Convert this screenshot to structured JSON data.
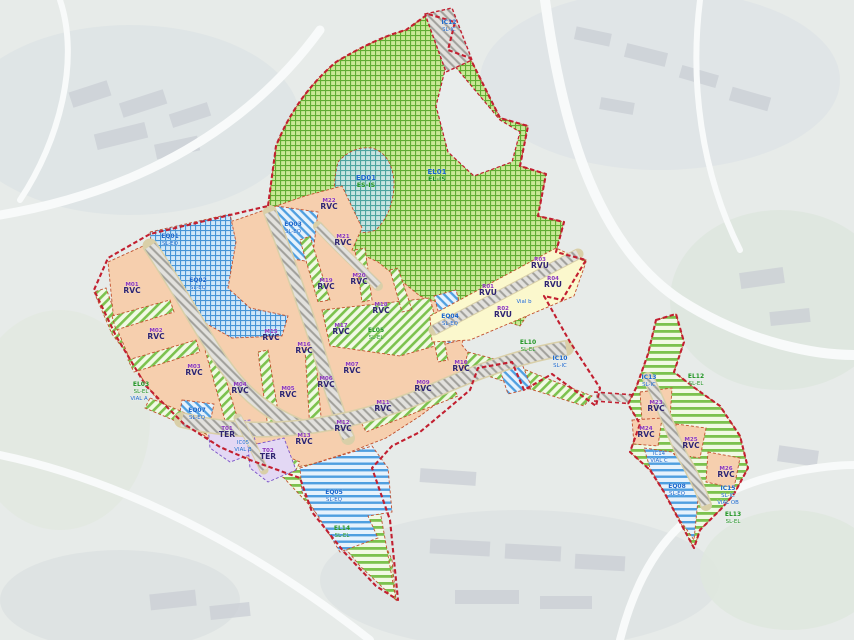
{
  "map": {
    "description": "Urban sector zoning plan over aerial photo",
    "colors": {
      "rvc_parcel": "#f6cfae",
      "rvu_parcel": "#fbf8cd",
      "ter_parcel": "#e3d8f4",
      "green_open_space": "#7cc24e",
      "blue_equipment": "#4f9fe0",
      "teal_zone": "#4da49f",
      "road_hatch": "#a09f9a",
      "sector_boundary": "#c21f30"
    },
    "zones": [
      {
        "id": "ic12",
        "type": "ic",
        "x": 449,
        "y": 24,
        "lines": [
          "IC12",
          "SL-IC"
        ]
      },
      {
        "id": "el01",
        "type": "elbig",
        "x": 437,
        "y": 174,
        "lines": [
          "EL01",
          "EL-IS"
        ]
      },
      {
        "id": "ed01",
        "type": "elbig",
        "x": 366,
        "y": 180,
        "lines": [
          "ED01",
          "ES-IS"
        ]
      },
      {
        "id": "eq03",
        "type": "eq",
        "x": 293,
        "y": 226,
        "lines": [
          "EQ03",
          "SL-EQ"
        ]
      },
      {
        "id": "eq01",
        "type": "eq",
        "x": 170,
        "y": 238,
        "lines": [
          "EQ01",
          "SL-EQ"
        ]
      },
      {
        "id": "eq02",
        "type": "eq",
        "x": 198,
        "y": 282,
        "lines": [
          "EQ02",
          "SL-EQ"
        ]
      },
      {
        "id": "m01",
        "type": "rvc",
        "x": 132,
        "y": 286,
        "lines": [
          "M01",
          "RVC"
        ]
      },
      {
        "id": "m02",
        "type": "rvc",
        "x": 156,
        "y": 332,
        "lines": [
          "M02",
          "RVC"
        ]
      },
      {
        "id": "m03",
        "type": "rvc",
        "x": 194,
        "y": 368,
        "lines": [
          "M03",
          "RVC"
        ]
      },
      {
        "id": "m04",
        "type": "rvc",
        "x": 240,
        "y": 386,
        "lines": [
          "M04",
          "RVC"
        ]
      },
      {
        "id": "m05",
        "type": "rvc",
        "x": 288,
        "y": 390,
        "lines": [
          "M05",
          "RVC"
        ]
      },
      {
        "id": "m06",
        "type": "rvc",
        "x": 326,
        "y": 380,
        "lines": [
          "M06",
          "RVC"
        ]
      },
      {
        "id": "m07",
        "type": "rvc",
        "x": 352,
        "y": 366,
        "lines": [
          "M07",
          "RVC"
        ]
      },
      {
        "id": "m09",
        "type": "rvc",
        "x": 423,
        "y": 384,
        "lines": [
          "M09",
          "RVC"
        ]
      },
      {
        "id": "m10",
        "type": "rvc",
        "x": 461,
        "y": 364,
        "lines": [
          "M10",
          "RVC"
        ]
      },
      {
        "id": "m11",
        "type": "rvc",
        "x": 383,
        "y": 404,
        "lines": [
          "M11",
          "RVC"
        ]
      },
      {
        "id": "m12",
        "type": "rvc",
        "x": 343,
        "y": 424,
        "lines": [
          "M12",
          "RVC"
        ]
      },
      {
        "id": "m13",
        "type": "rvc",
        "x": 304,
        "y": 437,
        "lines": [
          "M13",
          "RVC"
        ]
      },
      {
        "id": "m15",
        "type": "rvc",
        "x": 271,
        "y": 333,
        "lines": [
          "M15",
          "RVC"
        ]
      },
      {
        "id": "m16",
        "type": "rvc",
        "x": 304,
        "y": 346,
        "lines": [
          "M16",
          "RVC"
        ]
      },
      {
        "id": "m17",
        "type": "rvc",
        "x": 341,
        "y": 327,
        "lines": [
          "M17",
          "RVC"
        ]
      },
      {
        "id": "m18",
        "type": "rvc",
        "x": 381,
        "y": 306,
        "lines": [
          "M18",
          "RVC"
        ]
      },
      {
        "id": "m19",
        "type": "rvc",
        "x": 326,
        "y": 282,
        "lines": [
          "M19",
          "RVC"
        ]
      },
      {
        "id": "m20",
        "type": "rvc",
        "x": 359,
        "y": 277,
        "lines": [
          "M20",
          "RVC"
        ]
      },
      {
        "id": "m21",
        "type": "rvc",
        "x": 343,
        "y": 238,
        "lines": [
          "M21",
          "RVC"
        ]
      },
      {
        "id": "m22",
        "type": "rvc",
        "x": 329,
        "y": 202,
        "lines": [
          "M22",
          "RVC"
        ]
      },
      {
        "id": "el05",
        "type": "el",
        "x": 376,
        "y": 332,
        "lines": [
          "EL05",
          "SL-EL"
        ]
      },
      {
        "id": "eq04",
        "type": "eq",
        "x": 450,
        "y": 318,
        "lines": [
          "EQ04",
          "SL-EQ"
        ]
      },
      {
        "id": "rvu1",
        "type": "rvu",
        "x": 488,
        "y": 288,
        "lines": [
          "R01",
          "RVU"
        ]
      },
      {
        "id": "rvu2",
        "type": "rvu",
        "x": 503,
        "y": 310,
        "lines": [
          "R02",
          "RVU"
        ]
      },
      {
        "id": "rvu3",
        "type": "rvu",
        "x": 540,
        "y": 261,
        "lines": [
          "R03",
          "RVU"
        ]
      },
      {
        "id": "rvu4",
        "type": "rvu",
        "x": 553,
        "y": 280,
        "lines": [
          "R04",
          "RVU"
        ]
      },
      {
        "id": "vial-b",
        "type": "vial",
        "x": 524,
        "y": 303,
        "lines": [
          "Vial b"
        ]
      },
      {
        "id": "el10",
        "type": "el",
        "x": 528,
        "y": 344,
        "lines": [
          "EL10",
          "SL-EL"
        ]
      },
      {
        "id": "ic10",
        "type": "ic",
        "x": 560,
        "y": 360,
        "lines": [
          "IC10",
          "SL-IC"
        ]
      },
      {
        "id": "el03",
        "type": "el",
        "x": 141,
        "y": 386,
        "lines": [
          "EL03",
          "SL-EL"
        ]
      },
      {
        "id": "vial-a",
        "type": "vial",
        "x": 139,
        "y": 400,
        "lines": [
          "VIAL A"
        ]
      },
      {
        "id": "eq07",
        "type": "eq",
        "x": 197,
        "y": 412,
        "lines": [
          "EQ07",
          "SL-EQ"
        ]
      },
      {
        "id": "t01",
        "type": "ter",
        "x": 227,
        "y": 430,
        "lines": [
          "T01",
          "TER"
        ]
      },
      {
        "id": "t02",
        "type": "ter",
        "x": 268,
        "y": 452,
        "lines": [
          "T02",
          "TER"
        ]
      },
      {
        "id": "ic05",
        "type": "vial",
        "x": 243,
        "y": 444,
        "lines": [
          "IC05",
          "VIAL B"
        ]
      },
      {
        "id": "eq05",
        "type": "eq",
        "x": 334,
        "y": 494,
        "lines": [
          "EQ05",
          "SL-EQ"
        ]
      },
      {
        "id": "el14",
        "type": "el",
        "x": 342,
        "y": 530,
        "lines": [
          "EL14",
          "SL-EL"
        ]
      },
      {
        "id": "ic13",
        "type": "ic",
        "x": 649,
        "y": 379,
        "lines": [
          "IC13",
          "SL-IC"
        ]
      },
      {
        "id": "el12",
        "type": "el",
        "x": 696,
        "y": 378,
        "lines": [
          "EL12",
          "SL-EL"
        ]
      },
      {
        "id": "m23",
        "type": "rvc",
        "x": 656,
        "y": 404,
        "lines": [
          "M23",
          "RVC"
        ]
      },
      {
        "id": "m24",
        "type": "rvc",
        "x": 646,
        "y": 430,
        "lines": [
          "M24",
          "RVC"
        ]
      },
      {
        "id": "m25",
        "type": "rvc",
        "x": 691,
        "y": 441,
        "lines": [
          "M25",
          "RVC"
        ]
      },
      {
        "id": "m26",
        "type": "rvc",
        "x": 726,
        "y": 470,
        "lines": [
          "M26",
          "RVC"
        ]
      },
      {
        "id": "ic14",
        "type": "vial",
        "x": 659,
        "y": 455,
        "lines": [
          "IC14",
          "VIAL C"
        ]
      },
      {
        "id": "eq08",
        "type": "eq",
        "x": 677,
        "y": 488,
        "lines": [
          "EQ08",
          "SL-EQ"
        ]
      },
      {
        "id": "ic15",
        "type": "ic",
        "x": 728,
        "y": 490,
        "lines": [
          "IC15",
          "SL-IC",
          "VIAL OB"
        ]
      },
      {
        "id": "el13",
        "type": "el",
        "x": 733,
        "y": 516,
        "lines": [
          "EL13",
          "SL-EL"
        ]
      }
    ]
  }
}
